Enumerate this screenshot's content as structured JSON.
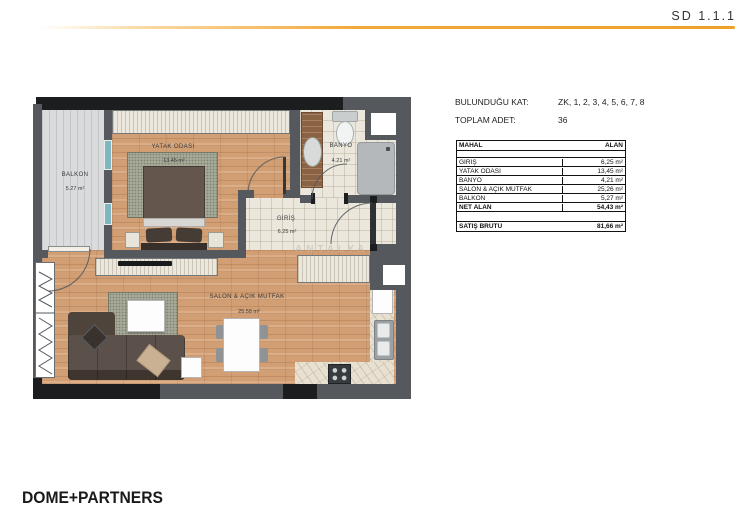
{
  "header": {
    "code": "SD 1.1.1"
  },
  "footer": {
    "brand": "DOME+PARTNERS"
  },
  "info": {
    "floor_label": "BULUNDUĞU KAT:",
    "floor_value": "ZK, 1, 2, 3, 4, 5, 6, 7, 8",
    "count_label": "TOPLAM ADET:",
    "count_value": "36"
  },
  "area_table": {
    "col_name": "MAHAL",
    "col_area": "ALAN",
    "rows": [
      {
        "name": "GİRİŞ",
        "value": "6,25 m²"
      },
      {
        "name": "YATAK ODASI",
        "value": "13,45 m²"
      },
      {
        "name": "BANYO",
        "value": "4,21 m²"
      },
      {
        "name": "SALON & AÇIK MUTFAK",
        "value": "25,26 m²"
      },
      {
        "name": "BALKON",
        "value": "5,27 m²"
      },
      {
        "name": "NET ALAN",
        "value": "54,43 m²"
      }
    ],
    "gross": {
      "name": "SATIŞ BRÜTÜ",
      "value": "81,66 m²"
    }
  },
  "plan": {
    "rooms": [
      {
        "name": "BALKON",
        "area": "5.27 m²"
      },
      {
        "name": "YATAK ODASI",
        "area": "13.45 m²"
      },
      {
        "name": "BANYO",
        "area": "4.21 m²"
      },
      {
        "name": "GİRİŞ",
        "area": "6.25 m²"
      },
      {
        "name": "SALON & AÇIK MUTFAK",
        "area": "25.58 m²"
      }
    ],
    "watermark": "ANTALYA"
  },
  "colors": {
    "accent": "#f0a63c",
    "wall": "#55595d",
    "structural": "#1b1d1f",
    "wood_floor": "#d29e74",
    "tile_floor": "#ece7dc",
    "balcony_floor": "#d9dbdc",
    "rug": "#a6a998"
  }
}
